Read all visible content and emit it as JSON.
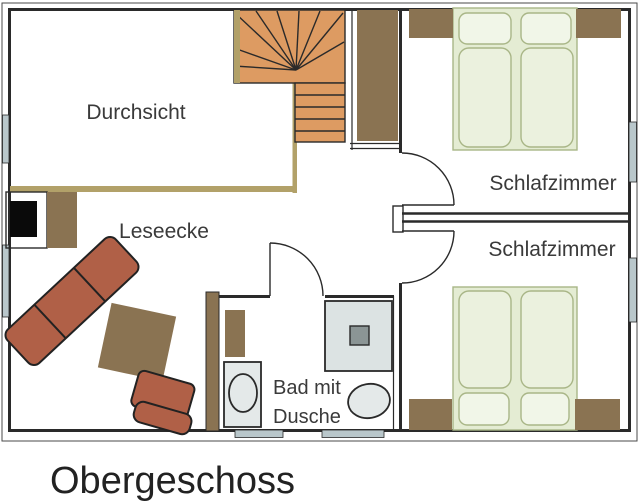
{
  "floor_plan": {
    "title": "Obergeschoss",
    "labels": {
      "gallery": "Durchsicht",
      "reading_corner": "Leseecke",
      "bedroom_top": "Schlafzimmer",
      "bedroom_bottom": "Schlafzimmer",
      "bathroom_line1": "Bad mit",
      "bathroom_line2": "Dusche"
    }
  },
  "colors": {
    "wall": "#2a2a2a",
    "stairs": "#dd9b62",
    "wood": "#8a7352",
    "railing": "#b2a169",
    "bed_frame": "#e4ecd3",
    "bed_mattress": "#ebf1de",
    "bed_pillow": "#f1f6e8",
    "bed_outline": "#a9b687",
    "window": "#b9c7cb",
    "fixture": "#e4e9e9",
    "shower": "#dce3e3",
    "drain": "#8b9595",
    "sofa": "#b06047",
    "stove": "#0a0a0a",
    "text": "#3a3a3a"
  }
}
